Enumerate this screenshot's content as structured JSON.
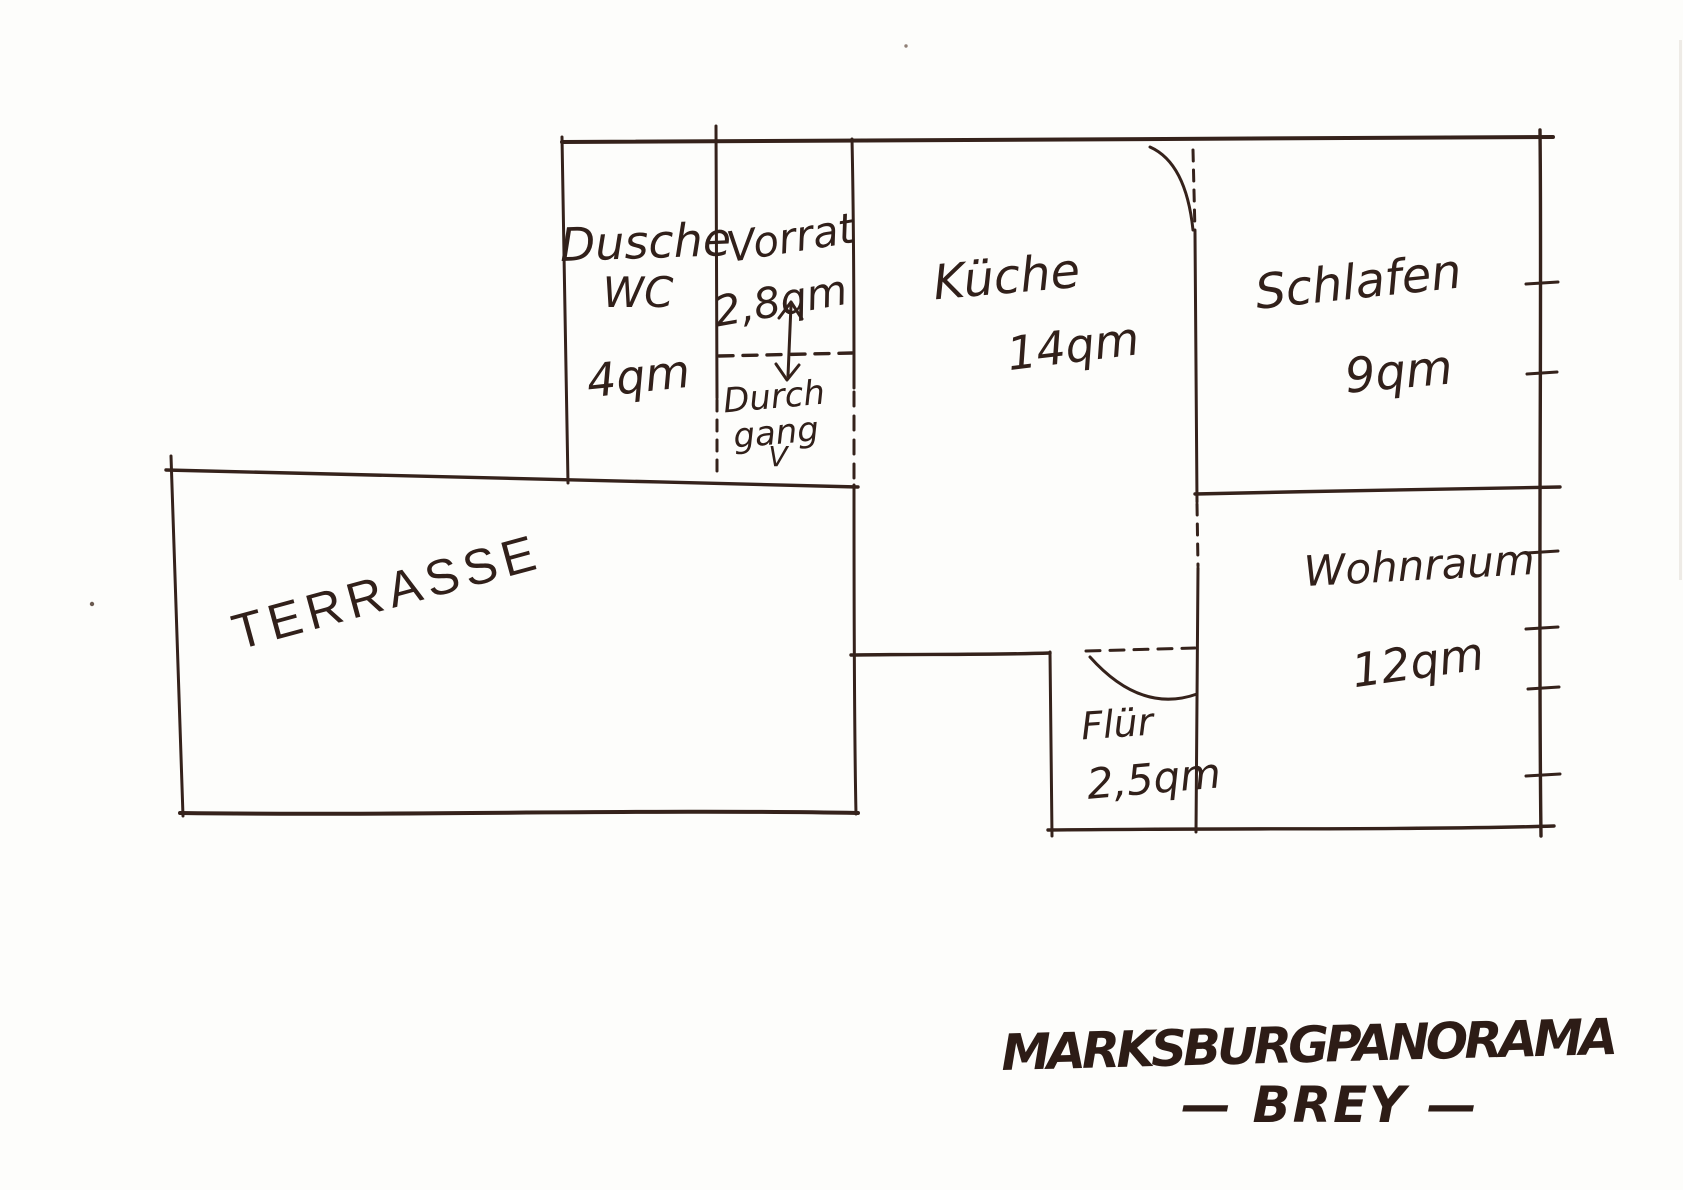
{
  "colors": {
    "ink": "#35221b",
    "paper": "#fdfdfb"
  },
  "rooms": {
    "dusche": {
      "line1": "Dusche",
      "line2": "WC",
      "area": "4qm"
    },
    "vorrat": {
      "label": "Vorrat",
      "area": "2,8qm"
    },
    "durchgang": {
      "line1": "Durch",
      "line2": "gang",
      "mark": "V"
    },
    "kueche": {
      "label": "Küche",
      "area": "14qm"
    },
    "schlafen": {
      "label": "Schlafen",
      "area": "9qm"
    },
    "wohnraum": {
      "label": "Wohnraum",
      "area": "12qm"
    },
    "flur": {
      "label": "Flür",
      "area": "2,5qm"
    },
    "terrasse": {
      "label": "TERRASSE"
    }
  },
  "caption": {
    "title": "MARKSBURGPANORAMA",
    "subtitle": "— BREY —"
  }
}
